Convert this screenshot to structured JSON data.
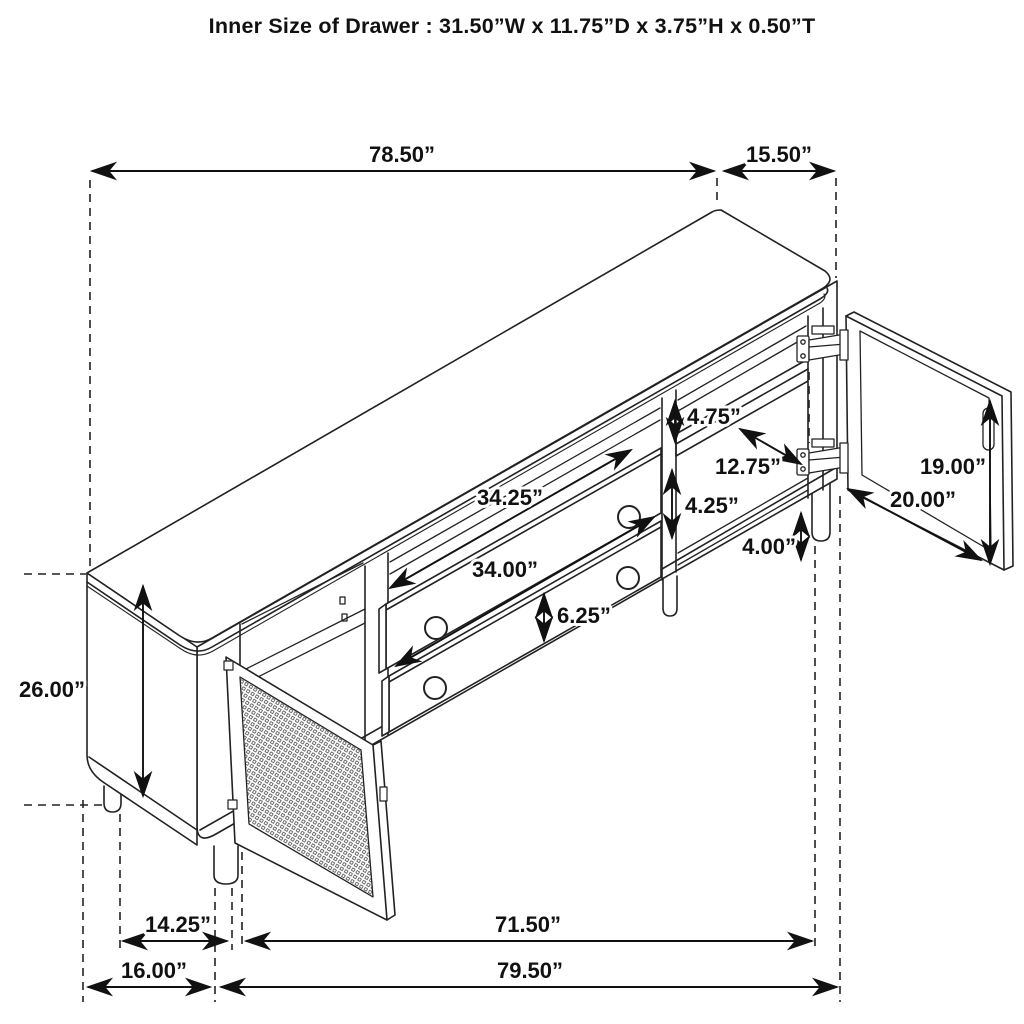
{
  "title": "Inner Size of Drawer : 31.50”W x 11.75”D x 3.75”H x 0.50”T",
  "dims": {
    "top_length": "78.50”",
    "top_depth": "15.50”",
    "overall_height": "26.00”",
    "upper_compartment_height": "4.75”",
    "shelf_depth": "12.75”",
    "drawer_opening_width": "34.25”",
    "lower_compartment_height": "4.25”",
    "leg_height": "4.00”",
    "drawer_width": "34.00”",
    "drawer_face_height": "6.25”",
    "right_door_height": "19.00”",
    "right_door_width": "20.00”",
    "left_leg_inset": "14.25”",
    "base_span": "71.50”",
    "left_section_width": "16.00”",
    "overall_width": "79.50”"
  },
  "colors": {
    "line": "#1d1d1d",
    "background": "#ffffff"
  }
}
